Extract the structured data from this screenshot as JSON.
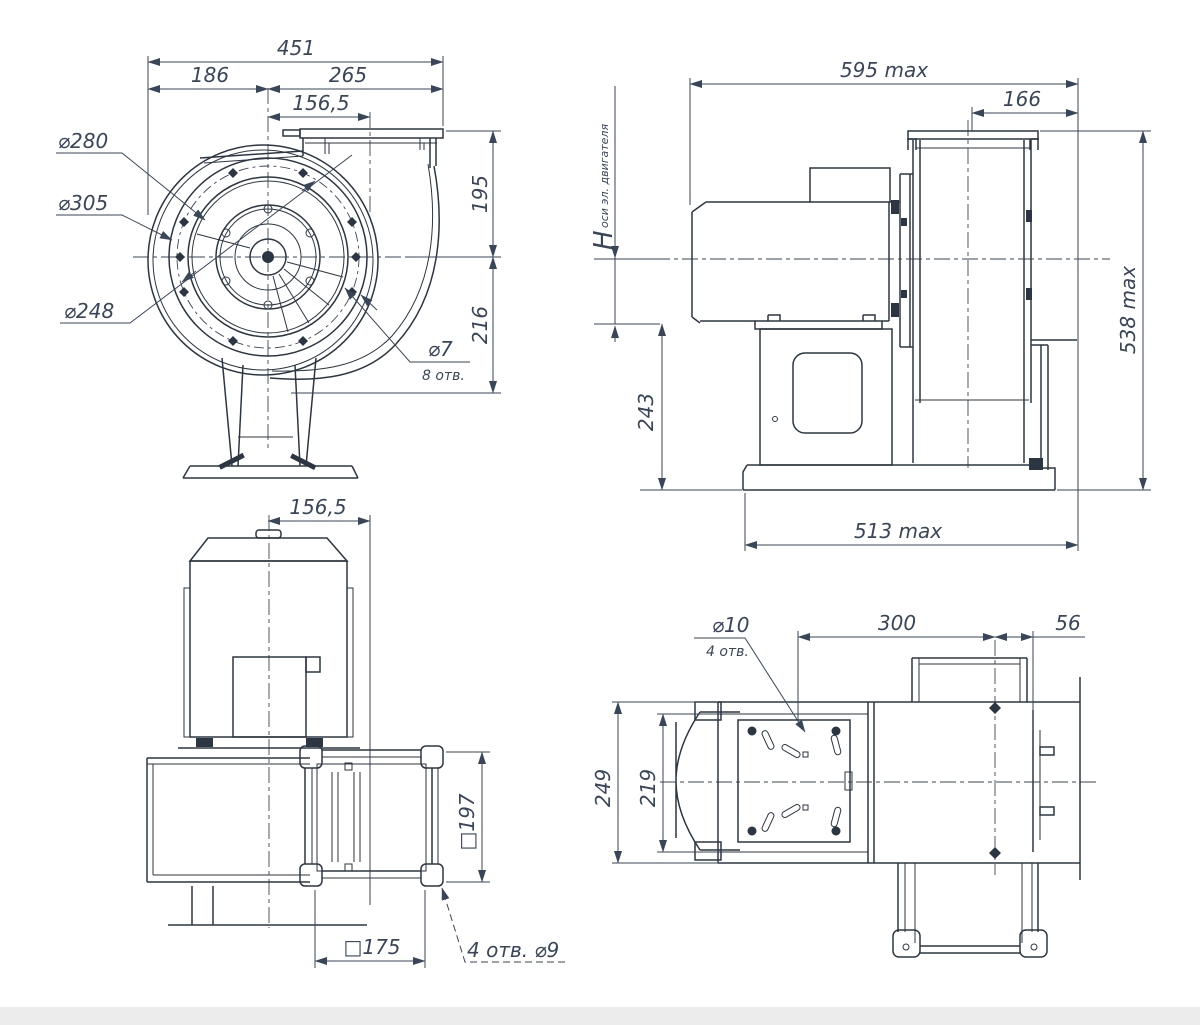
{
  "drawing": {
    "front": {
      "d451": "451",
      "d186": "186",
      "d265": "265",
      "d156": "156,5",
      "d195": "195",
      "d216": "216",
      "dia280": "⌀280",
      "dia305": "⌀305",
      "dia248": "⌀248",
      "dia7": "⌀7",
      "holes8": "8 отв."
    },
    "side": {
      "d595": "595 max",
      "d166": "166",
      "h": "H",
      "h_sub": "оси эл. двигателя",
      "d243": "243",
      "d538": "538 max",
      "d513": "513 max"
    },
    "plan": {
      "d156": "156,5",
      "d197": "□197",
      "d175": "□175",
      "holes": "4 отв.  ⌀9"
    },
    "top": {
      "dia10": "⌀10",
      "holes4": "4 отв.",
      "d300": "300",
      "d56": "56",
      "d249": "249",
      "d219": "219"
    }
  }
}
